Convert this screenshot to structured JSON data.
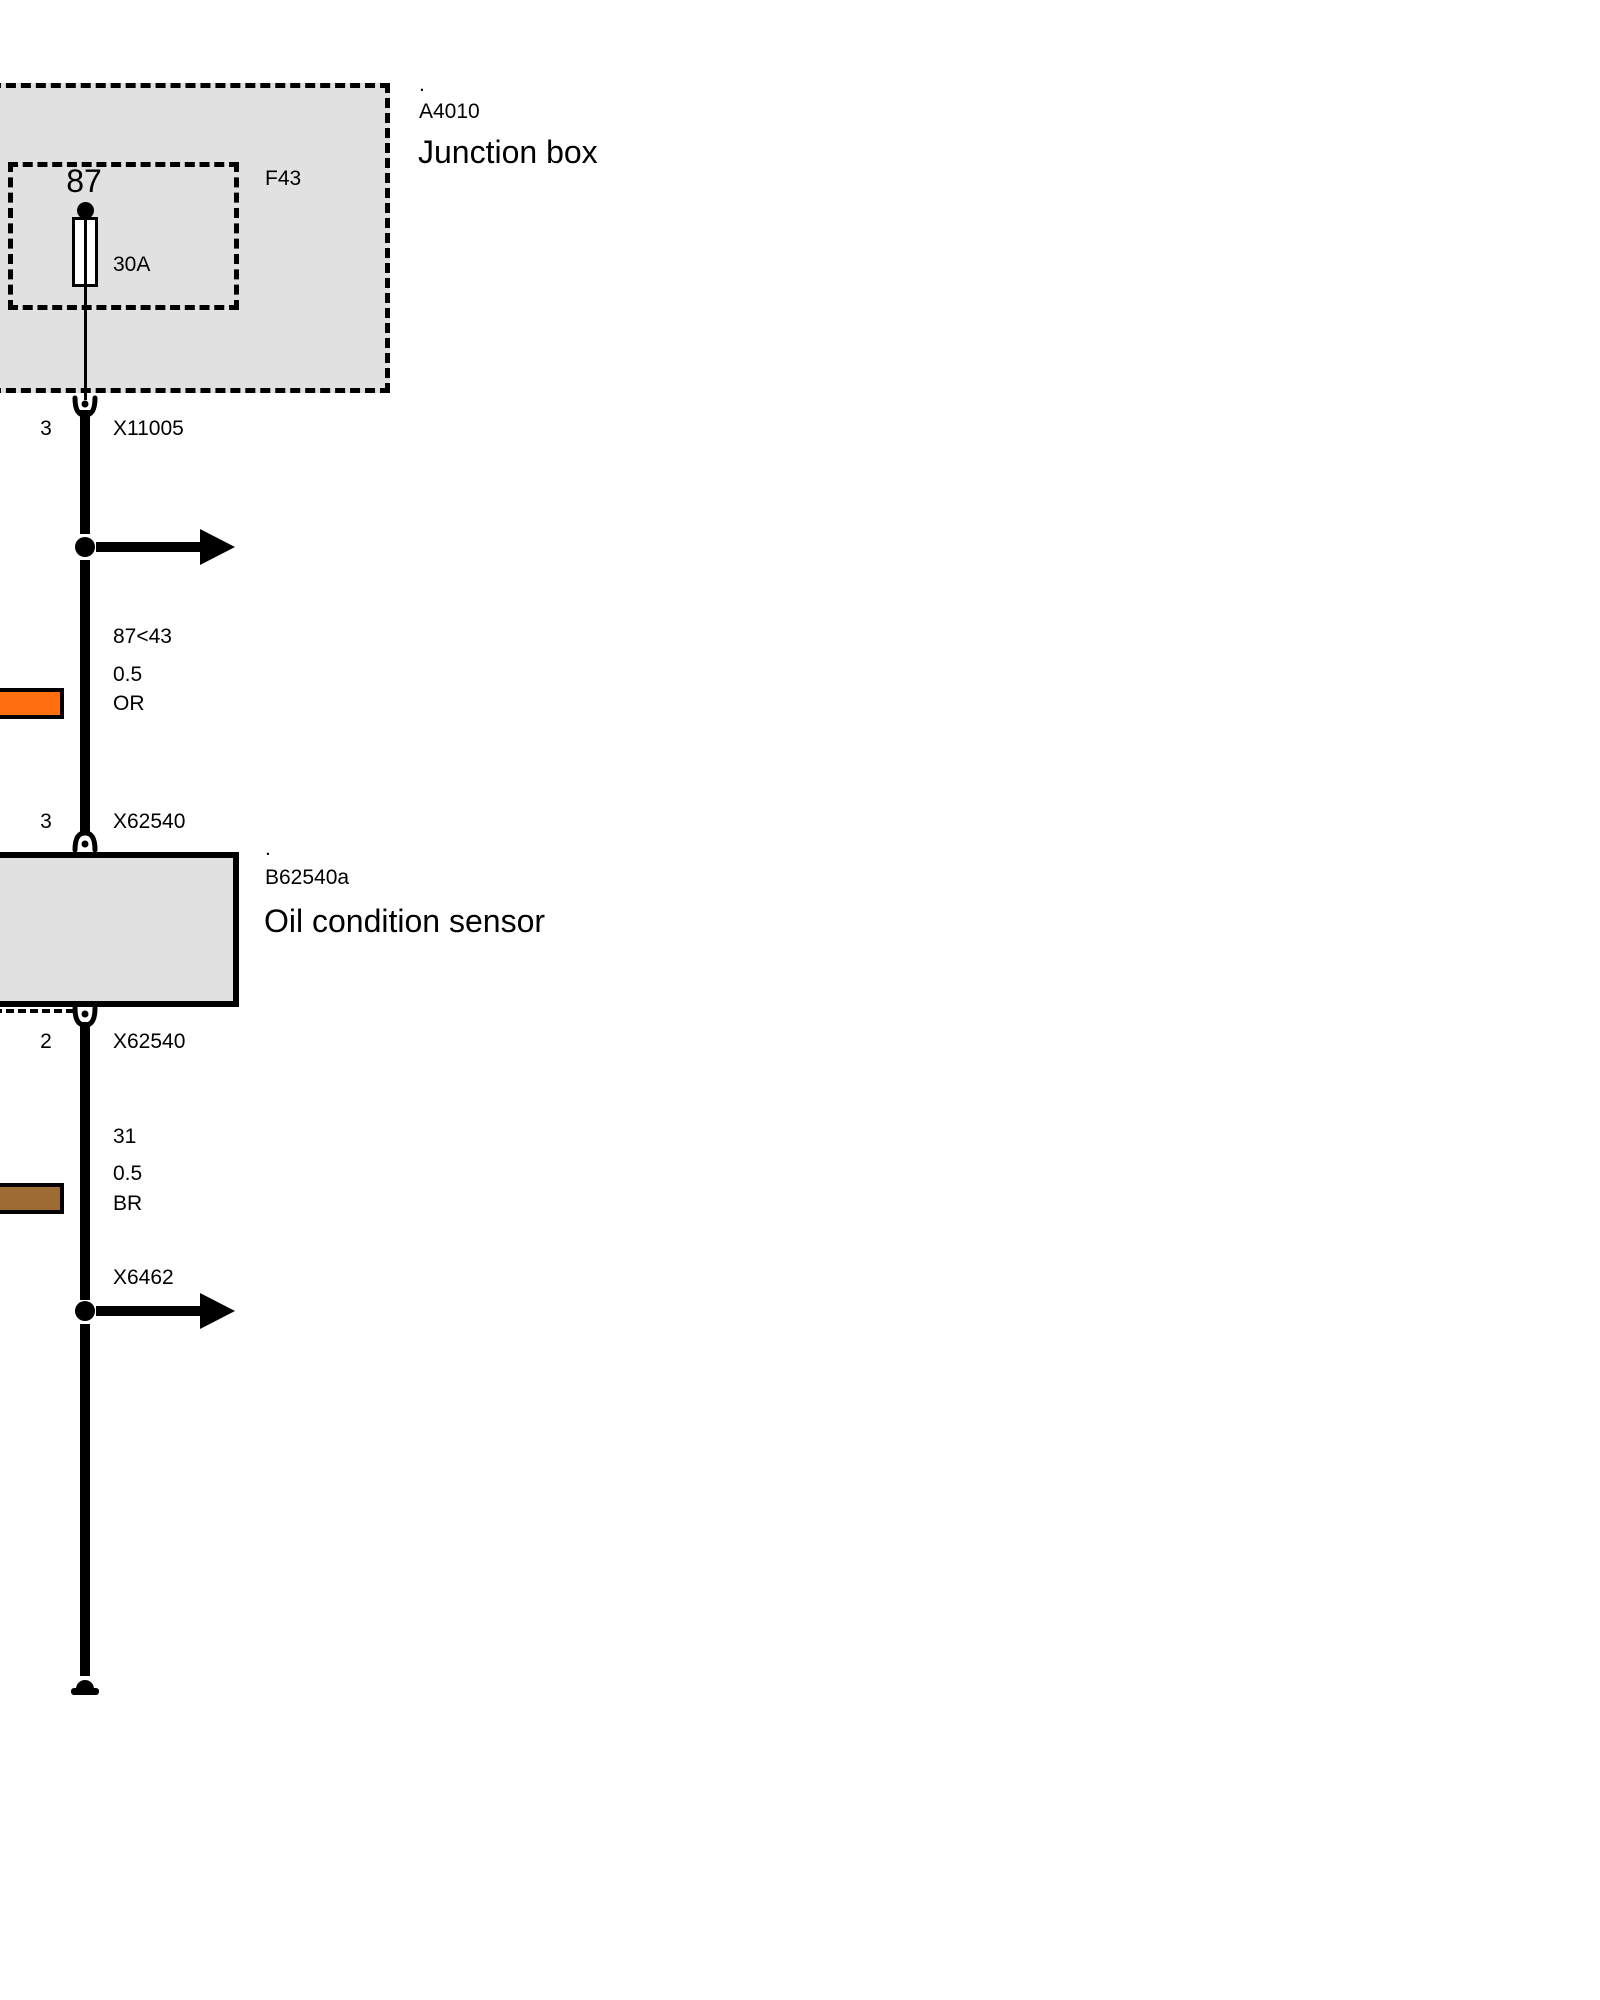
{
  "colors": {
    "box_fill": "#E1E1E1",
    "diagram_line": "#000000",
    "wire_or": "#FF6E0F",
    "wire_br": "#9F6B35"
  },
  "junction_box": {
    "dot": ".",
    "code": "A4010",
    "title": "Junction box",
    "fuse": {
      "terminal": "87",
      "name": "F43",
      "rating": "30A"
    },
    "connector": {
      "pin": "3",
      "name": "X11005"
    }
  },
  "supply_wire": {
    "circuit": "87<43",
    "cross_section": "0.5",
    "color_code": "OR"
  },
  "sensor": {
    "dot": ".",
    "code": "B62540a",
    "title": "Oil condition sensor",
    "connector_in": {
      "pin": "3",
      "name": "X62540"
    },
    "connector_out": {
      "pin": "2",
      "name": "X62540"
    }
  },
  "ground_wire": {
    "circuit": "31",
    "cross_section": "0.5",
    "color_code": "BR",
    "branch_connector": "X6462"
  }
}
